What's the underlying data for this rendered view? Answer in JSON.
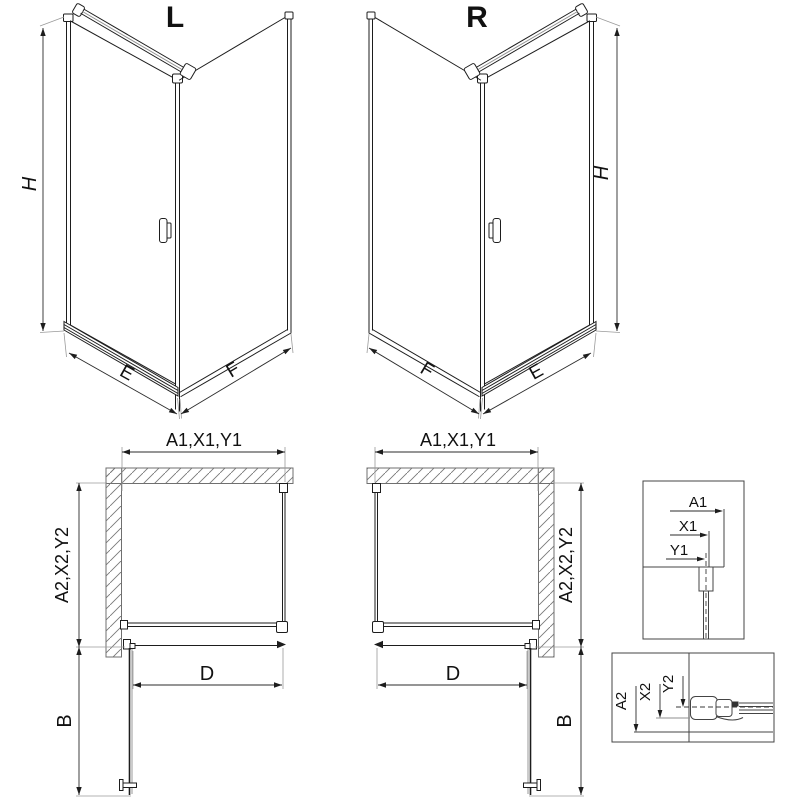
{
  "colors": {
    "line": "#1d1d1d",
    "dimension": "#2b2b2b",
    "wall_hatch": "#6f6f6f",
    "background": "#ffffff"
  },
  "iso_left": {
    "label": "L",
    "height_label": "H",
    "door_width_label": "E",
    "panel_width_label": "F"
  },
  "iso_right": {
    "label": "R",
    "height_label": "H",
    "door_width_label": "E",
    "panel_width_label": "F"
  },
  "plan_left": {
    "width_label": "A1,X1,Y1",
    "depth_label": "A2,X2,Y2",
    "entry_label": "D",
    "swing_label": "B"
  },
  "plan_right": {
    "width_label": "A1,X1,Y1",
    "depth_label": "A2,X2,Y2",
    "entry_label": "D",
    "swing_label": "B"
  },
  "detail_width": {
    "outer": "A1",
    "middle": "X1",
    "inner": "Y1"
  },
  "detail_depth": {
    "outer": "A2",
    "middle": "X2",
    "inner": "Y2"
  }
}
